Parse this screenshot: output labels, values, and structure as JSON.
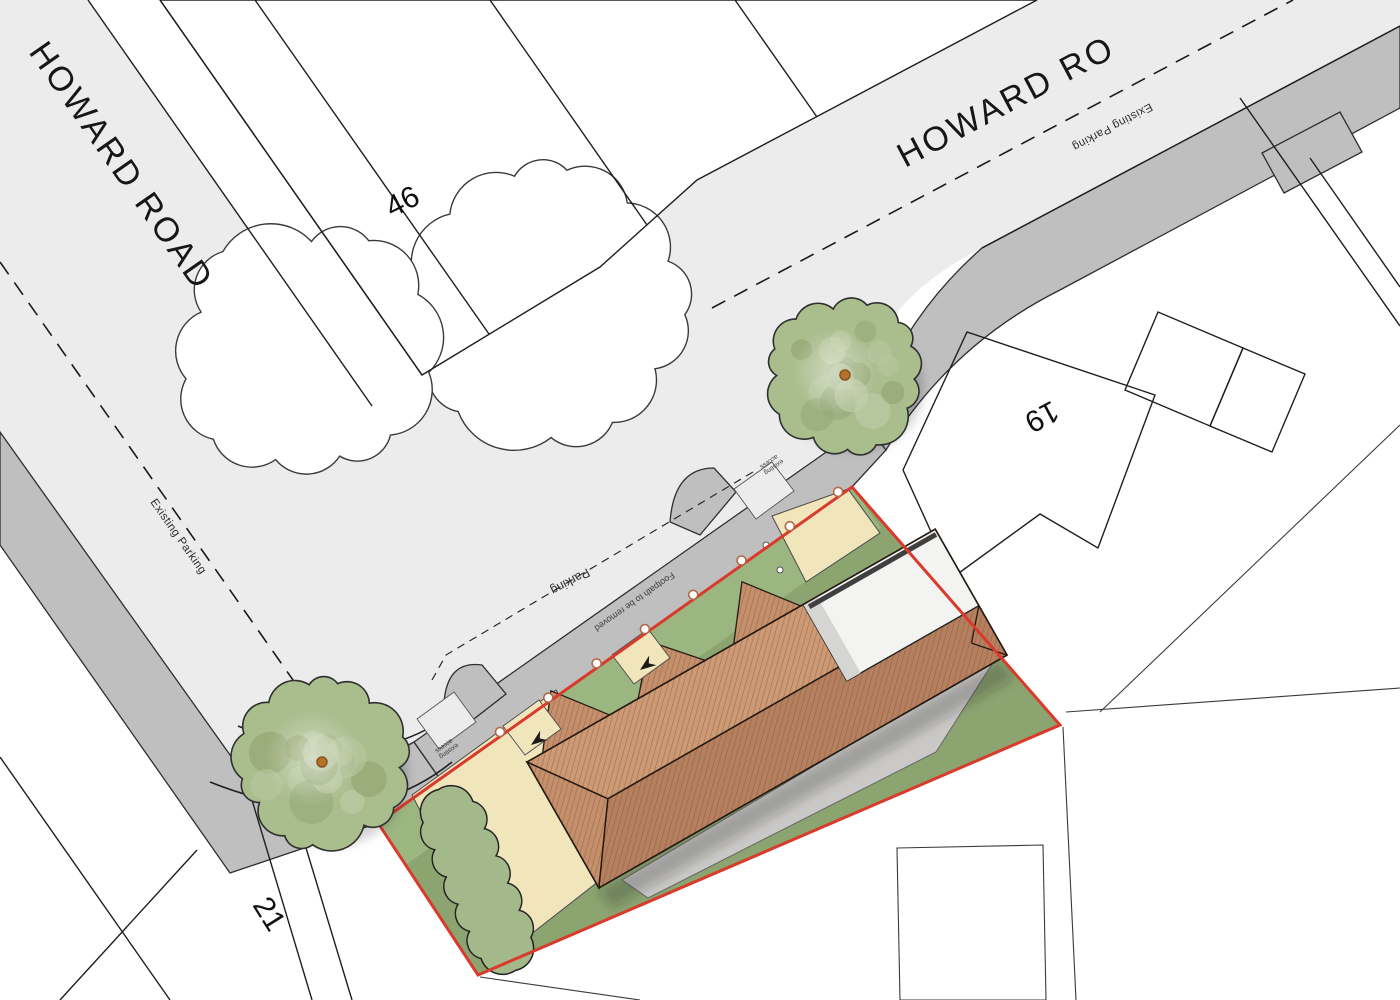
{
  "title": "Howard Road proposed site plan",
  "labels": {
    "road_left": "HOWARD ROAD",
    "road_right": "HOWARD RO",
    "plot_46": "46",
    "plot_19": "19",
    "plot_21": "21",
    "existing_parking_left": "Existing Parking",
    "existing_parking_right": "Existing Parking",
    "parking_bay": "Parking",
    "footpath_note": "Footpath to be removed",
    "access_note_line1": "existing",
    "access_note_line2": "access"
  },
  "colors": {
    "road_surface": "#ececec",
    "pavement": "#bfbfbf",
    "plot_white": "#ffffff",
    "site_lawn": "#8ba470",
    "lawn_light": "#9cb681",
    "cream": "#f0e5bb",
    "crossover": "#ececec",
    "roof": "#c4906c",
    "roof_light": "#cc9a75",
    "roof_dark": "#b5805f",
    "white_roof": "#f3f3f2",
    "white_roof_shade": "#d5d5d3",
    "patio": "#cac9c7",
    "boundary_red": "#d93a2c",
    "tree_green": "#a9bd8d",
    "tree_mottle_dark": "#8fa06b",
    "hedge_green": "#a4b98a",
    "linework": "#222222",
    "trunk": "#b5722a"
  }
}
